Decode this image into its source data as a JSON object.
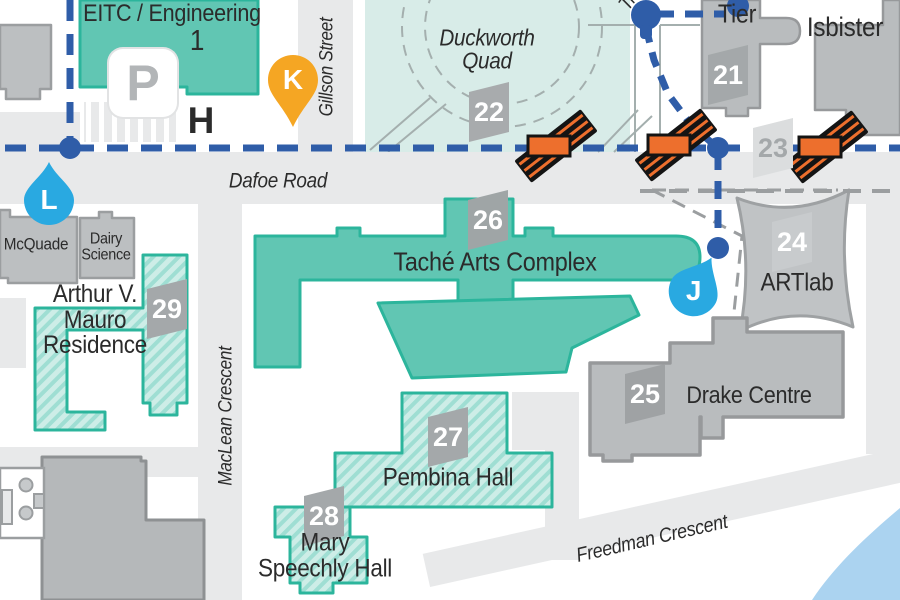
{
  "map": {
    "streets": {
      "dafoe": "Dafoe Road",
      "gillson": "Gillson Street",
      "maclean": "MacLean Crescent",
      "freedman": "Freedman Crescent",
      "partial_top": "Tr"
    },
    "places": {
      "duckworth": "Duckworth\nQuad"
    },
    "buildings": {
      "eitc": {
        "name": "EITC / Engineering",
        "number": "1"
      },
      "tier": {
        "name": "Tier"
      },
      "isbister": {
        "name": "Isbister"
      },
      "artlab": {
        "name": "ARTlab"
      },
      "drake": {
        "name": "Drake Centre"
      },
      "tache": {
        "name": "Taché Arts Complex"
      },
      "pembina": {
        "name": "Pembina Hall"
      },
      "mary": {
        "name": "Mary\nSpeechly Hall"
      },
      "mauro": {
        "name": "Arthur V.\nMauro\nResidence"
      },
      "mcquade": {
        "name": "McQuade"
      },
      "dairy": {
        "name": "Dairy\nScience"
      }
    },
    "badges": {
      "b21": "21",
      "b22": "22",
      "b23": "23",
      "b24": "24",
      "b25": "25",
      "b26": "26",
      "b27": "27",
      "b28": "28",
      "b29": "29"
    },
    "markers": {
      "k": "K",
      "l": "L",
      "j": "J",
      "h": "H",
      "parking": "P"
    },
    "colors": {
      "route_blue": "#2f5da8",
      "stop_blue": "#29a9e1",
      "pin_yellow": "#f5a623",
      "construction_orange": "#ed6f2d",
      "building_teal": "#61c6b3",
      "teal_outline": "#2cb59c",
      "quad_teal": "#d8ece8",
      "building_gray": "#bcbfc1",
      "road_gray": "#e8e9ea",
      "water_blue": "#abd3f0"
    }
  }
}
